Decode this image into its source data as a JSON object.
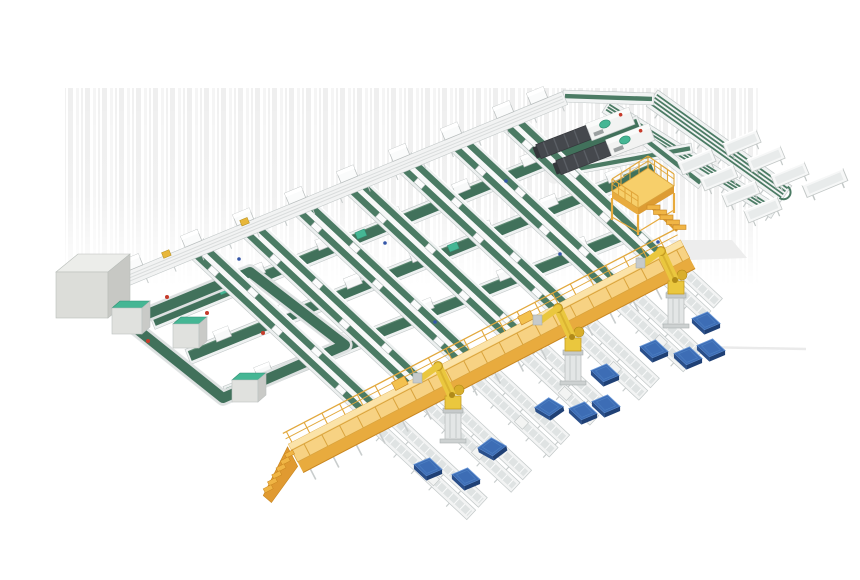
{
  "scene_description": "3D isometric render of an automated parcel sortation and robotic palletizing facility",
  "canvas": {
    "width": 860,
    "height": 580,
    "background": "#ffffff"
  },
  "palette": {
    "belt_green": "#4b7b64",
    "belt_green_dark": "#41715b",
    "belt_green_edge": "#5d8a72",
    "frame_white": "#f1f3f3",
    "frame_stroke": "#c2c8c8",
    "teal_cap": "#45b694",
    "teal_edge": "#2f8f72",
    "walkway_top": "#f7d283",
    "walkway_hi": "#fbe3a8",
    "walkway_side": "#e8ab3e",
    "walkway_deep": "#c9861f",
    "rail_yellow": "#e2a83c",
    "robot_yellow": "#eac73e",
    "robot_shade": "#c79d22",
    "pedestal_gray": "#e3e6e6",
    "pallet_top": "#3d6db5",
    "pallet_side": "#2a4f8a",
    "pallet_dark": "#1f4075",
    "pallet_hi": "#6b99d8",
    "machine_dark": "#45484d",
    "machine_seg": "#5a5e64",
    "cabinet_gray": "#e0e1de",
    "stripe_light": "#efefef",
    "shadow": "#ededed",
    "red_dot": "#c63b2b",
    "blue_dot": "#3557a8"
  },
  "counts": {
    "robots": 3,
    "pallets": 11,
    "sort_lanes": 7,
    "cross_lines": 3,
    "chute_tables": 8,
    "telescopic_machines": 2
  },
  "items": [
    {
      "type": "stripes",
      "name": "background-wall-stripes",
      "x": 65,
      "y": 88,
      "w": 693,
      "h": 198
    },
    {
      "type": "shadowQuad",
      "name": "floor-shadow-patch",
      "pts": [
        [
          668,
          240
        ],
        [
          732,
          240
        ],
        [
          747,
          258
        ],
        [
          690,
          260
        ]
      ]
    },
    {
      "type": "shadowLine",
      "name": "floor-shadow-streak",
      "x1": 700,
      "y1": 347,
      "x2": 806,
      "y2": 349
    },
    {
      "type": "shadowBand",
      "name": "machine-floor-shadow",
      "x1": 545,
      "y1": 174,
      "x2": 652,
      "y2": 132,
      "w": 26
    },
    {
      "type": "sorter",
      "name": "sorter-return-conveyor",
      "x1": 606,
      "y1": 106,
      "x2": 775,
      "y2": 212,
      "w": 15,
      "tracks": 3,
      "cap": false
    },
    {
      "type": "sorter",
      "name": "sorter-spine-conveyor",
      "x1": 652,
      "y1": 98,
      "x2": 786,
      "y2": 194,
      "w": 20,
      "tracks": 4,
      "cap": true
    },
    {
      "type": "link",
      "name": "trunk-to-sorter-connector",
      "x1": 563,
      "y1": 96,
      "x2": 654,
      "y2": 99,
      "w": 12
    },
    {
      "type": "link",
      "name": "sorter-feed-lane",
      "x1": 560,
      "y1": 172,
      "x2": 692,
      "y2": 148,
      "w": 10
    },
    {
      "type": "link",
      "name": "machine-outfeed-lane",
      "x1": 628,
      "y1": 126,
      "x2": 702,
      "y2": 184,
      "w": 12
    },
    {
      "type": "table",
      "name": "chute-table",
      "cx": 697,
      "cy": 162
    },
    {
      "type": "table",
      "name": "chute-table",
      "cx": 719,
      "cy": 178
    },
    {
      "type": "table",
      "name": "chute-table",
      "cx": 741,
      "cy": 194
    },
    {
      "type": "table",
      "name": "chute-table",
      "cx": 763,
      "cy": 210
    },
    {
      "type": "table",
      "name": "chute-table",
      "cx": 742,
      "cy": 143
    },
    {
      "type": "table",
      "name": "chute-table",
      "cx": 766,
      "cy": 159
    },
    {
      "type": "table",
      "name": "chute-table",
      "cx": 790,
      "cy": 175
    },
    {
      "type": "table",
      "name": "chute-table",
      "cx": 825,
      "cy": 183,
      "len": 44
    },
    {
      "type": "row",
      "name": "cross-belt-line",
      "x1": 152,
      "y1": 322,
      "x2": 640,
      "y2": 123,
      "canopies": [
        0.08,
        0.22,
        0.36,
        0.5,
        0.64,
        0.78,
        0.92
      ],
      "caps": [
        0.15,
        0.43,
        0.71
      ]
    },
    {
      "type": "row",
      "name": "cross-belt-line",
      "x1": 188,
      "y1": 357,
      "x2": 655,
      "y2": 168,
      "canopies": [
        0.08,
        0.22,
        0.36,
        0.5,
        0.64,
        0.78,
        0.92
      ],
      "caps": [
        0.29,
        0.57,
        0.85
      ]
    },
    {
      "type": "row",
      "name": "cross-belt-line",
      "x1": 226,
      "y1": 394,
      "x2": 630,
      "y2": 233,
      "canopies": [
        0.1,
        0.3,
        0.5,
        0.7,
        0.88
      ],
      "caps": [
        0.2,
        0.6
      ]
    },
    {
      "type": "loop",
      "name": "buffer-loop-conveyor",
      "pts": [
        [
          128,
          322
        ],
        [
          250,
          272
        ],
        [
          345,
          345
        ],
        [
          223,
          398
        ]
      ]
    },
    {
      "type": "column",
      "name": "sort-lane",
      "x1": 196,
      "y1": 247,
      "x2": 373,
      "y2": 412,
      "carriers": [
        0.12,
        0.3,
        0.48,
        0.66,
        0.84
      ]
    },
    {
      "type": "column",
      "name": "sort-lane",
      "x1": 248,
      "y1": 226,
      "x2": 421,
      "y2": 388,
      "carriers": [
        0.18,
        0.38,
        0.58,
        0.78
      ]
    },
    {
      "type": "column",
      "name": "sort-lane",
      "x1": 300,
      "y1": 204,
      "x2": 470,
      "y2": 363,
      "carriers": [
        0.12,
        0.3,
        0.48,
        0.66,
        0.84
      ]
    },
    {
      "type": "column",
      "name": "sort-lane",
      "x1": 352,
      "y1": 183,
      "x2": 518,
      "y2": 338,
      "carriers": [
        0.2,
        0.45,
        0.7,
        0.9
      ]
    },
    {
      "type": "column",
      "name": "sort-lane",
      "x1": 404,
      "y1": 161,
      "x2": 567,
      "y2": 313,
      "carriers": [
        0.12,
        0.3,
        0.48,
        0.66,
        0.84
      ]
    },
    {
      "type": "column",
      "name": "sort-lane",
      "x1": 456,
      "y1": 140,
      "x2": 615,
      "y2": 288,
      "carriers": [
        0.18,
        0.38,
        0.58,
        0.78
      ]
    },
    {
      "type": "column",
      "name": "sort-lane",
      "x1": 508,
      "y1": 119,
      "x2": 663,
      "y2": 264,
      "carriers": [
        0.15,
        0.4,
        0.65,
        0.85
      ]
    },
    {
      "type": "trunk",
      "name": "infeed-trunk-conveyor",
      "x1": 105,
      "y1": 288,
      "x2": 565,
      "y2": 98,
      "canopies": [
        {
          "f": 0.07
        },
        {
          "f": 0.198
        },
        {
          "f": 0.311
        },
        {
          "f": 0.424
        },
        {
          "f": 0.537
        },
        {
          "f": 0.65
        },
        {
          "f": 0.763
        },
        {
          "f": 0.876
        },
        {
          "f": 0.95
        },
        {
          "f": 0.14,
          "c": "#e8b73a",
          "small": true
        },
        {
          "f": 0.31,
          "c": "#e8b73a",
          "small": true
        }
      ]
    },
    {
      "type": "machine",
      "name": "telescopic-loader-machine",
      "x": 600,
      "y": 128,
      "rot": -21
    },
    {
      "type": "machine",
      "name": "telescopic-loader-machine",
      "x": 620,
      "y": 144,
      "rot": -21
    },
    {
      "type": "bigbox",
      "name": "control-cabinet-large",
      "x": 56,
      "y": 272,
      "w": 52,
      "h": 46,
      "d": 22
    },
    {
      "type": "cabinet",
      "name": "teal-top-cabinet",
      "x": 112,
      "y": 308,
      "w": 30,
      "h": 26,
      "teal": true
    },
    {
      "type": "cabinet",
      "name": "teal-top-cabinet",
      "x": 173,
      "y": 324,
      "w": 26,
      "h": 24,
      "teal": true
    },
    {
      "type": "cabinet",
      "name": "teal-top-cabinet",
      "x": 232,
      "y": 380,
      "w": 26,
      "h": 22,
      "teal": true
    },
    {
      "type": "dotRed",
      "name": "status-marker-red",
      "x": 167,
      "y": 297
    },
    {
      "type": "dotRed",
      "name": "status-marker-red",
      "x": 207,
      "y": 313
    },
    {
      "type": "dotRed",
      "name": "status-marker-red",
      "x": 148,
      "y": 341
    },
    {
      "type": "dotRed",
      "name": "status-marker-red",
      "x": 263,
      "y": 333
    },
    {
      "type": "dotBlue",
      "name": "status-marker-blue",
      "x": 239,
      "y": 259
    },
    {
      "type": "dotBlue",
      "name": "status-marker-blue",
      "x": 385,
      "y": 243
    },
    {
      "type": "dotBlue",
      "name": "status-marker-blue",
      "x": 506,
      "y": 181
    },
    {
      "type": "dotBlue",
      "name": "status-marker-blue",
      "x": 560,
      "y": 254
    },
    {
      "type": "dotBlue",
      "name": "status-marker-blue",
      "x": 435,
      "y": 322
    },
    {
      "type": "dotBlue",
      "name": "status-marker-blue",
      "x": 658,
      "y": 242
    },
    {
      "type": "mezzanine",
      "name": "operator-platform",
      "cx": 643,
      "cy": 189
    },
    {
      "type": "spur",
      "name": "outfeed-roller-lane",
      "x1": 382,
      "y1": 420,
      "len": 130
    },
    {
      "type": "spur",
      "name": "outfeed-roller-lane",
      "x1": 430,
      "y1": 396,
      "len": 125
    },
    {
      "type": "spur",
      "name": "outfeed-roller-lane",
      "x1": 479,
      "y1": 371,
      "len": 110
    },
    {
      "type": "spur",
      "name": "outfeed-roller-lane",
      "x1": 527,
      "y1": 346,
      "len": 100
    },
    {
      "type": "spur",
      "name": "outfeed-roller-lane",
      "x1": 576,
      "y1": 321,
      "len": 100
    },
    {
      "type": "spur",
      "name": "outfeed-roller-lane",
      "x1": 624,
      "y1": 296,
      "len": 95
    },
    {
      "type": "spur",
      "name": "outfeed-roller-lane",
      "x1": 672,
      "y1": 272,
      "len": 55
    },
    {
      "type": "walkway",
      "name": "elevated-walkway",
      "x1": 293,
      "y1": 453,
      "x2": 685,
      "y2": 249,
      "stairs": true
    },
    {
      "type": "robot",
      "name": "palletizing-robot",
      "x": 453,
      "y": 443
    },
    {
      "type": "robot",
      "name": "palletizing-robot",
      "x": 573,
      "y": 385
    },
    {
      "type": "robot",
      "name": "palletizing-robot",
      "x": 676,
      "y": 328
    },
    {
      "type": "pallet",
      "name": "blue-pallet",
      "x": 428,
      "y": 467,
      "rot": 0
    },
    {
      "type": "pallet",
      "name": "blue-pallet",
      "x": 466,
      "y": 477,
      "rot": 0
    },
    {
      "type": "pallet",
      "name": "blue-pallet",
      "x": 492,
      "y": 447,
      "rot": -14
    },
    {
      "type": "pallet",
      "name": "blue-pallet",
      "x": 549,
      "y": 407,
      "rot": -12
    },
    {
      "type": "pallet",
      "name": "blue-pallet",
      "x": 583,
      "y": 411,
      "rot": 0
    },
    {
      "type": "pallet",
      "name": "blue-pallet",
      "x": 606,
      "y": 404,
      "rot": 0
    },
    {
      "type": "pallet",
      "name": "blue-pallet",
      "x": 605,
      "y": 373,
      "rot": 0
    },
    {
      "type": "pallet",
      "name": "blue-pallet",
      "x": 654,
      "y": 349,
      "rot": 0
    },
    {
      "type": "pallet",
      "name": "blue-pallet",
      "x": 688,
      "y": 356,
      "rot": 0
    },
    {
      "type": "pallet",
      "name": "blue-pallet",
      "x": 711,
      "y": 348,
      "rot": 0
    },
    {
      "type": "pallet",
      "name": "blue-pallet",
      "x": 706,
      "y": 321,
      "rot": 0
    }
  ]
}
